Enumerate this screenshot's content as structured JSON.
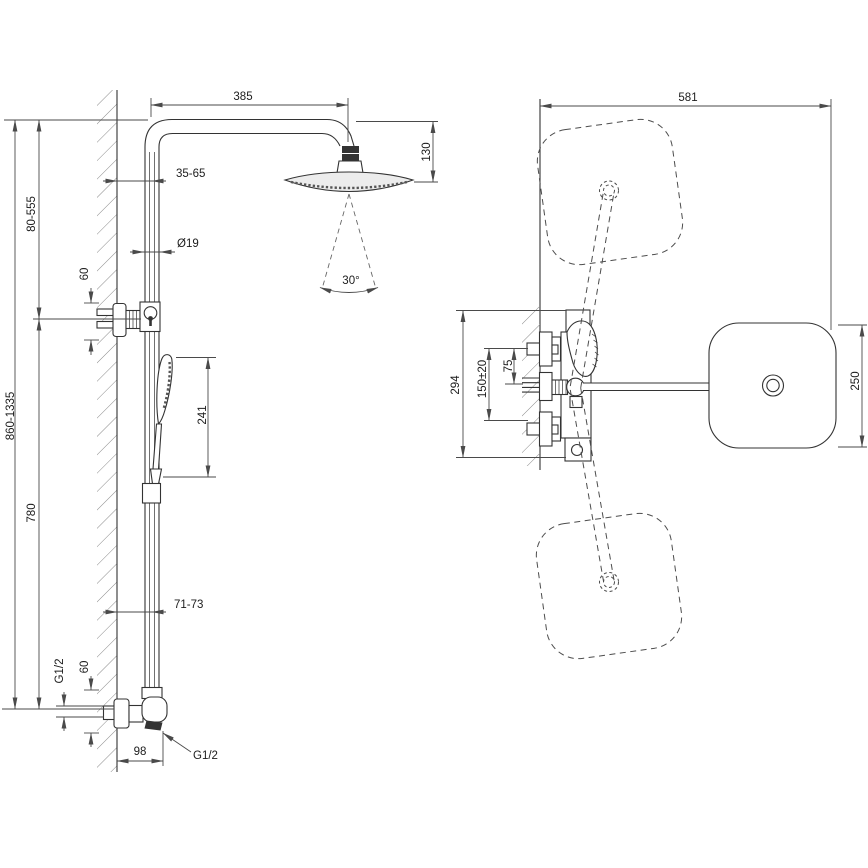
{
  "drawing_type": "shower-system-installation-dimensions",
  "colors": {
    "background": "#ffffff",
    "line": "#333333",
    "dimension_line": "#4a4a4a",
    "label_text": "#1c1c1c",
    "hatch": "#8a8a8a",
    "dark_fill": "#333333",
    "head_fill": "#ececec"
  },
  "side_view": {
    "dimensions": {
      "overall_height": "860-1335",
      "upper_section_height": "80-555",
      "lower_section_height": "780",
      "arm_reach": "385",
      "head_height": "130",
      "wall_to_pipe_upper": "35-65",
      "pipe_diameter": "Ø19",
      "bracket_offset": "60",
      "hand_shower_length": "241",
      "wall_to_pipe_lower": "71-73",
      "inlet_thread": "G1/2",
      "inlet_offset": "60",
      "outlet_offset": "98",
      "outlet_thread": "G1/2",
      "spray_angle": "30°"
    }
  },
  "front_view": {
    "dimensions": {
      "head_reach": "581",
      "mixer_body_height": "294",
      "inlet_center_distance": "150±20",
      "handle_to_inlet": "75",
      "head_width": "250"
    }
  }
}
